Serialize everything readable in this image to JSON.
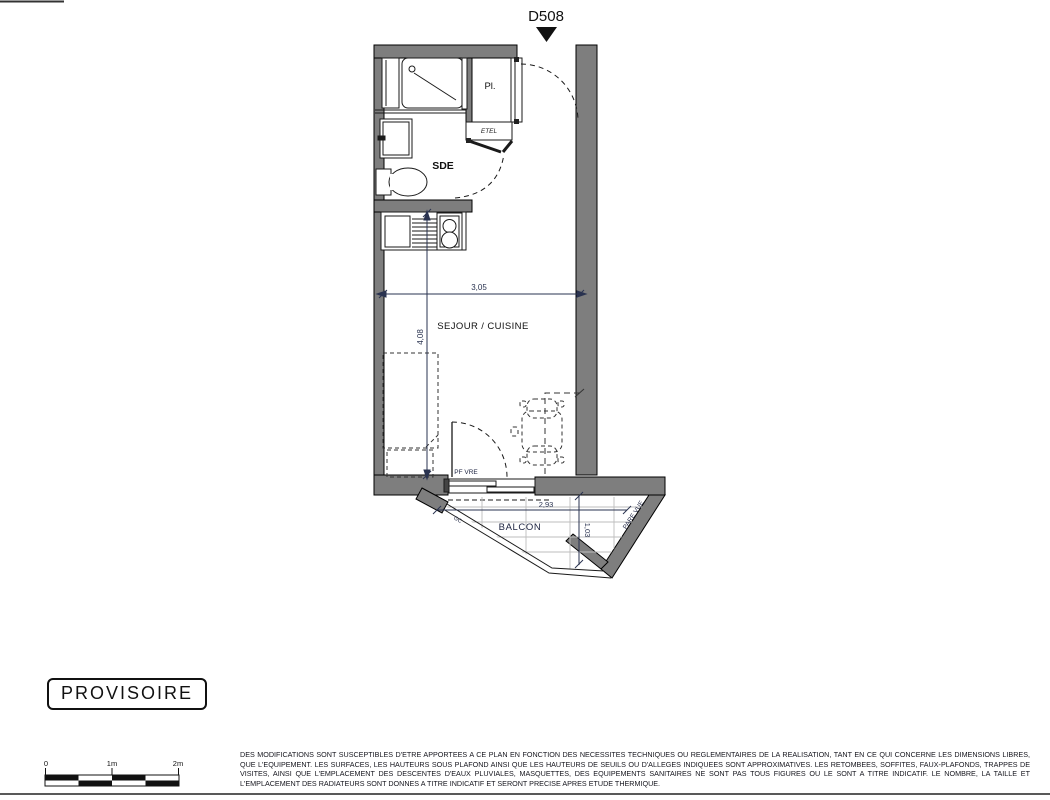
{
  "header": {
    "unit_label": "D508"
  },
  "plan": {
    "room_labels": {
      "bathroom": "SDE",
      "closet": "Pl.",
      "electrical": "ETEL",
      "living": "SEJOUR / CUISINE",
      "balcony": "BALCON"
    },
    "dimensions": {
      "living_width": "3,05",
      "living_length": "4,08",
      "balcony_width": "2,93",
      "balcony_depth": "1,03"
    },
    "annotations": {
      "french_window": "PF VRE",
      "guardrail": "GC",
      "privacy_screen": "PARE VUE"
    }
  },
  "stamp": {
    "label": "PROVISOIRE"
  },
  "scale_bar": {
    "labels": [
      "0",
      "1m",
      "2m"
    ]
  },
  "footer": {
    "disclaimer": "DES MODIFICATIONS SONT SUSCEPTIBLES D'ETRE APPORTEES A CE PLAN EN FONCTION DES NECESSITES TECHNIQUES OU REGLEMENTAIRES DE LA REALISATION, TANT EN CE QUI CONCERNE LES DIMENSIONS LIBRES, QUE L'EQUIPEMENT. LES SURFACES, LES HAUTEURS SOUS PLAFOND AINSI QUE LES HAUTEURS DE SEUILS OU D'ALLEGES INDIQUEES SONT APPROXIMATIVES. LES RETOMBEES, SOFFITES, FAUX-PLAFONDS, TRAPPES DE VISITES, AINSI QUE L'EMPLACEMENT DES DESCENTES D'EAUX PLUVIALES, MASQUETTES, DES EQUIPEMENTS SANITAIRES NE SONT PAS TOUS FIGURES OU LE SONT A TITRE INDICATIF. LE NOMBRE, LA TAILLE ET L'EMPLACEMENT DES RADIATEURS SONT DONNES A TITRE INDICATIF ET SERONT PRECISE APRES ETUDE THERMIQUE."
  },
  "colors": {
    "wall": "#7e7e7e",
    "line": "#1a1a1a",
    "annotation": "#2a3350",
    "tile": "#bdbdbd"
  }
}
